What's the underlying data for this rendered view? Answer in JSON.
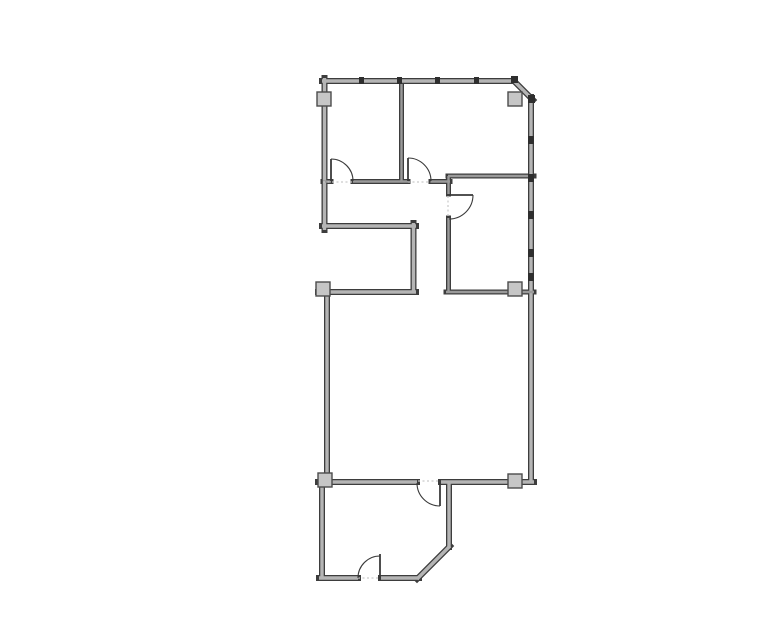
{
  "document": {
    "type": "floor-plan-drawing",
    "background": "#ffffff"
  },
  "canvas": {
    "width": 777,
    "height": 633
  },
  "colors": {
    "wall_stroke": "#3d3d3d",
    "wall_core_exterior": "#b5b5b5",
    "wall_core_interior": "#9a9a9a",
    "column_fill": "#c6c6c6",
    "column_stroke": "#4c4c4c",
    "door_line": "#3a3a3a",
    "threshold_dotted": "#c9c9c9",
    "mullion_mark": "#2e2e2e"
  },
  "plan": {
    "walls": {
      "exterior": [
        {
          "name": "top-wall",
          "x1": 322,
          "y1": 81,
          "x2": 515,
          "y2": 81
        },
        {
          "name": "chamfer-corner-wall",
          "x1": 513,
          "y1": 80,
          "x2": 533,
          "y2": 100
        },
        {
          "name": "right-wall",
          "x1": 531,
          "y1": 97,
          "x2": 531,
          "y2": 482
        },
        {
          "name": "left-wall-upper",
          "x1": 324.5,
          "y1": 78,
          "x2": 324.5,
          "y2": 230
        },
        {
          "name": "notch-wall-horizontal",
          "x1": 322,
          "y1": 226,
          "x2": 416,
          "y2": 226
        },
        {
          "name": "notch-wall-vertical",
          "x1": 413.5,
          "y1": 223,
          "x2": 413.5,
          "y2": 292
        },
        {
          "name": "mid-room-top-left-wall",
          "x1": 318,
          "y1": 292,
          "x2": 416,
          "y2": 292
        },
        {
          "name": "mid-room-left-wall",
          "x1": 327,
          "y1": 292,
          "x2": 327,
          "y2": 478
        },
        {
          "name": "mid-room-bottom-left",
          "x1": 318,
          "y1": 482,
          "x2": 417,
          "y2": 482
        },
        {
          "name": "mid-room-bottom-right",
          "x1": 441,
          "y1": 482,
          "x2": 534,
          "y2": 482
        },
        {
          "name": "bottom-room-left-wall",
          "x1": 322,
          "y1": 482,
          "x2": 322,
          "y2": 578
        },
        {
          "name": "bottom-room-bottom-a",
          "x1": 319,
          "y1": 578,
          "x2": 358,
          "y2": 578
        },
        {
          "name": "bottom-room-bottom-b",
          "x1": 381,
          "y1": 578,
          "x2": 419,
          "y2": 578
        },
        {
          "name": "bottom-room-diagonal",
          "x1": 417,
          "y1": 579,
          "x2": 450,
          "y2": 546
        },
        {
          "name": "bottom-room-right-wall",
          "x1": 449,
          "y1": 482,
          "x2": 449,
          "y2": 547
        }
      ],
      "interior": [
        {
          "name": "top-rooms-divider",
          "x1": 401.5,
          "y1": 84,
          "x2": 401.5,
          "y2": 181
        },
        {
          "name": "corridor-north-a",
          "x1": 323,
          "y1": 181.5,
          "x2": 331,
          "y2": 181.5
        },
        {
          "name": "corridor-north-b",
          "x1": 353,
          "y1": 181.5,
          "x2": 408,
          "y2": 181.5
        },
        {
          "name": "corridor-north-c",
          "x1": 431,
          "y1": 181.5,
          "x2": 450,
          "y2": 181.5
        },
        {
          "name": "right-room-top-wall",
          "x1": 448,
          "y1": 176,
          "x2": 534,
          "y2": 176
        },
        {
          "name": "right-room-left-stub",
          "x1": 448.5,
          "y1": 176,
          "x2": 448.5,
          "y2": 194
        },
        {
          "name": "right-room-left-wall",
          "x1": 448.5,
          "y1": 218,
          "x2": 448.5,
          "y2": 292
        },
        {
          "name": "right-room-bottom-wall",
          "x1": 446,
          "y1": 292,
          "x2": 534,
          "y2": 292
        }
      ],
      "exterior_thickness": 6,
      "interior_thickness": 5
    },
    "columns": [
      {
        "name": "column-top-left",
        "x": 317,
        "y": 92,
        "w": 14,
        "h": 14
      },
      {
        "name": "column-top-right",
        "x": 508,
        "y": 92,
        "w": 14,
        "h": 14
      },
      {
        "name": "column-mid-left",
        "x": 316,
        "y": 282,
        "w": 14,
        "h": 14
      },
      {
        "name": "column-mid-right",
        "x": 508,
        "y": 282,
        "w": 14,
        "h": 14
      },
      {
        "name": "column-bottom-left",
        "x": 318,
        "y": 473,
        "w": 14,
        "h": 14
      },
      {
        "name": "column-bottom-right",
        "x": 508,
        "y": 474,
        "w": 14,
        "h": 14
      }
    ],
    "doors": [
      {
        "name": "door-top-left-room",
        "leaf": [
          331,
          159,
          331,
          181
        ],
        "arc_start": [
          331,
          159
        ],
        "arc_end": [
          353,
          181
        ],
        "radius": 22,
        "sweep": 1
      },
      {
        "name": "door-top-middle-room",
        "leaf": [
          408,
          158,
          408,
          181
        ],
        "arc_start": [
          408,
          158
        ],
        "arc_end": [
          431,
          181
        ],
        "radius": 23,
        "sweep": 1
      },
      {
        "name": "door-right-room",
        "leaf": [
          449,
          195,
          473,
          195
        ],
        "arc_start": [
          473,
          195
        ],
        "arc_end": [
          449,
          219
        ],
        "radius": 24,
        "sweep": 1
      },
      {
        "name": "door-middle-to-bottom",
        "leaf": [
          440,
          483,
          440,
          506
        ],
        "arc_start": [
          417,
          483
        ],
        "arc_end": [
          440,
          506
        ],
        "radius": 23,
        "sweep": 0
      },
      {
        "name": "door-bottom-room-exit",
        "leaf": [
          380,
          554,
          380,
          578
        ],
        "arc_start": [
          358,
          578
        ],
        "arc_end": [
          380,
          556
        ],
        "radius": 22,
        "sweep": 1
      }
    ],
    "thresholds": [
      {
        "name": "threshold-top-left-door",
        "x1": 323,
        "y1": 182,
        "x2": 353,
        "y2": 182
      },
      {
        "name": "threshold-top-middle-door",
        "x1": 408,
        "y1": 182,
        "x2": 431,
        "y2": 182
      },
      {
        "name": "threshold-right-room-door",
        "x1": 448,
        "y1": 196,
        "x2": 448,
        "y2": 218
      },
      {
        "name": "threshold-middle-bottom-door",
        "x1": 418,
        "y1": 481,
        "x2": 440,
        "y2": 481
      },
      {
        "name": "threshold-bottom-exit-door",
        "x1": 358,
        "y1": 578,
        "x2": 380,
        "y2": 578
      }
    ],
    "mullions": [
      {
        "name": "mullion-top-1",
        "x": 359,
        "y": 77,
        "w": 5,
        "h": 7
      },
      {
        "name": "mullion-top-2",
        "x": 397,
        "y": 77,
        "w": 5,
        "h": 7
      },
      {
        "name": "mullion-top-3",
        "x": 435,
        "y": 77,
        "w": 5,
        "h": 7
      },
      {
        "name": "mullion-top-4",
        "x": 474,
        "y": 77,
        "w": 5,
        "h": 7
      },
      {
        "name": "mullion-chamfer-top",
        "x": 511,
        "y": 76,
        "w": 7,
        "h": 7
      },
      {
        "name": "mullion-chamfer-bottom",
        "x": 528,
        "y": 95,
        "w": 7,
        "h": 8
      },
      {
        "name": "mullion-right-1",
        "x": 528,
        "y": 136,
        "w": 6,
        "h": 8
      },
      {
        "name": "mullion-right-2",
        "x": 528,
        "y": 174,
        "w": 6,
        "h": 8
      },
      {
        "name": "mullion-right-3",
        "x": 528,
        "y": 211,
        "w": 6,
        "h": 8
      },
      {
        "name": "mullion-right-4",
        "x": 528,
        "y": 249,
        "w": 6,
        "h": 8
      },
      {
        "name": "mullion-right-5",
        "x": 528,
        "y": 273,
        "w": 6,
        "h": 8
      }
    ]
  }
}
